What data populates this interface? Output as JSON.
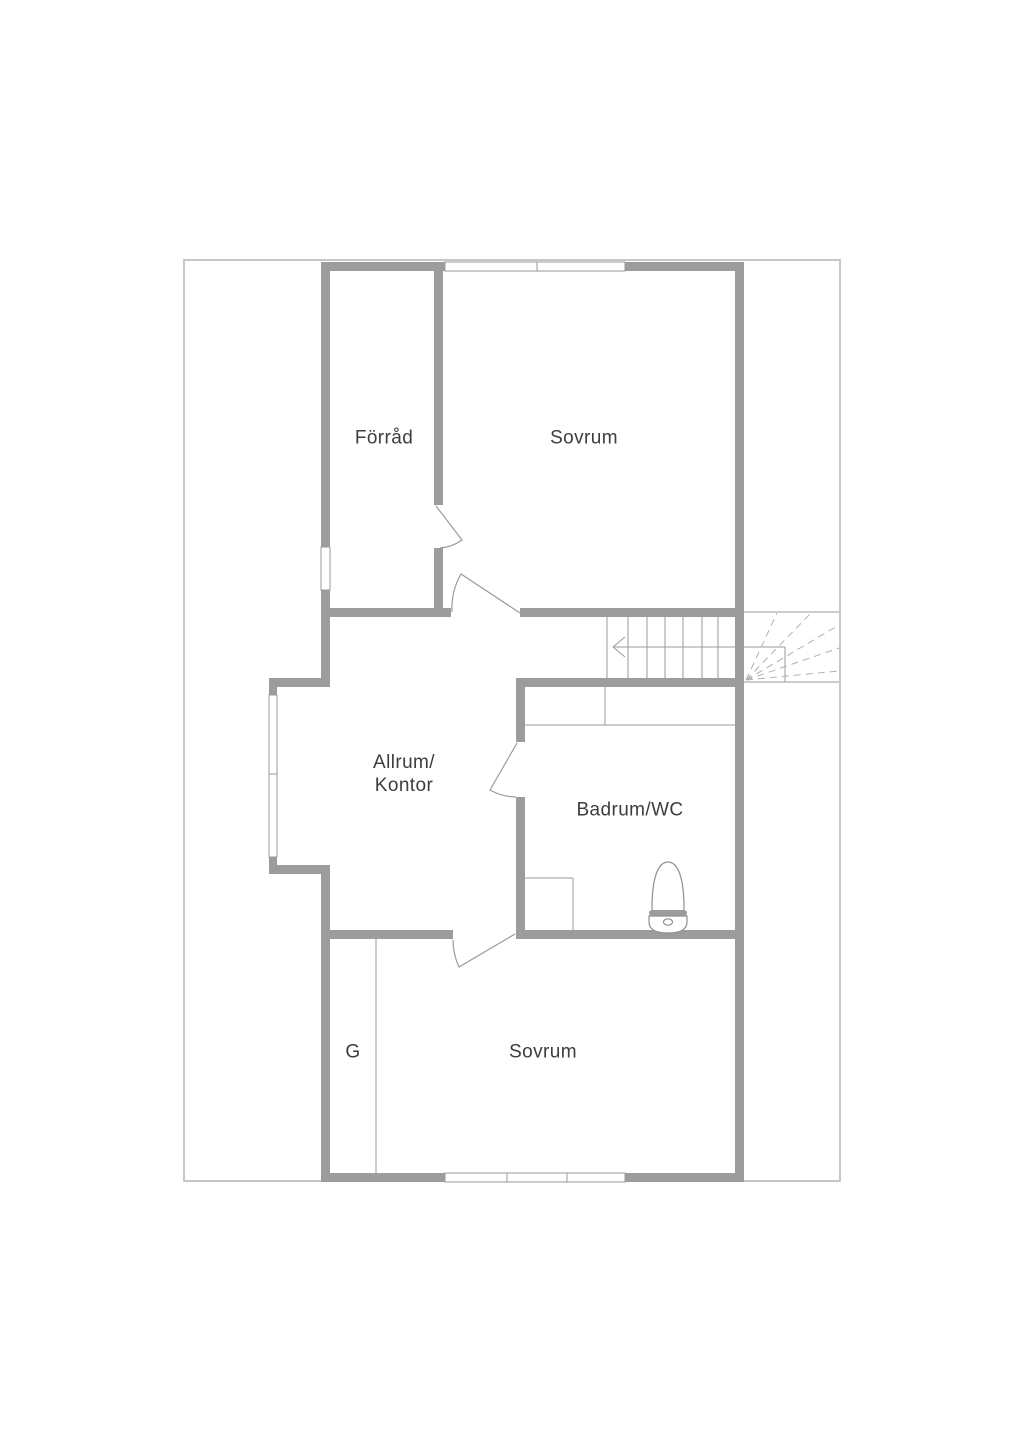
{
  "plan": {
    "title": "floor-plan",
    "rooms": [
      {
        "id": "forrad",
        "label": "Förråd"
      },
      {
        "id": "sovrum-top",
        "label": "Sovrum"
      },
      {
        "id": "allrum-kontor",
        "label": "Allrum/\nKontor"
      },
      {
        "id": "badrum-wc",
        "label": "Badrum/WC"
      },
      {
        "id": "garderob",
        "label": "G"
      },
      {
        "id": "sovrum-bottom",
        "label": "Sovrum"
      }
    ],
    "icons": {
      "stair_direction_arrow": "arrow-left",
      "toilet": "toilet-plan-symbol"
    },
    "colors": {
      "background": "#ffffff",
      "wall": "#9c9c9c",
      "line": "#9a9a9a",
      "border": "#b3b3b3",
      "dash": "#b0b0b0",
      "text": "#3d3d3d"
    }
  }
}
